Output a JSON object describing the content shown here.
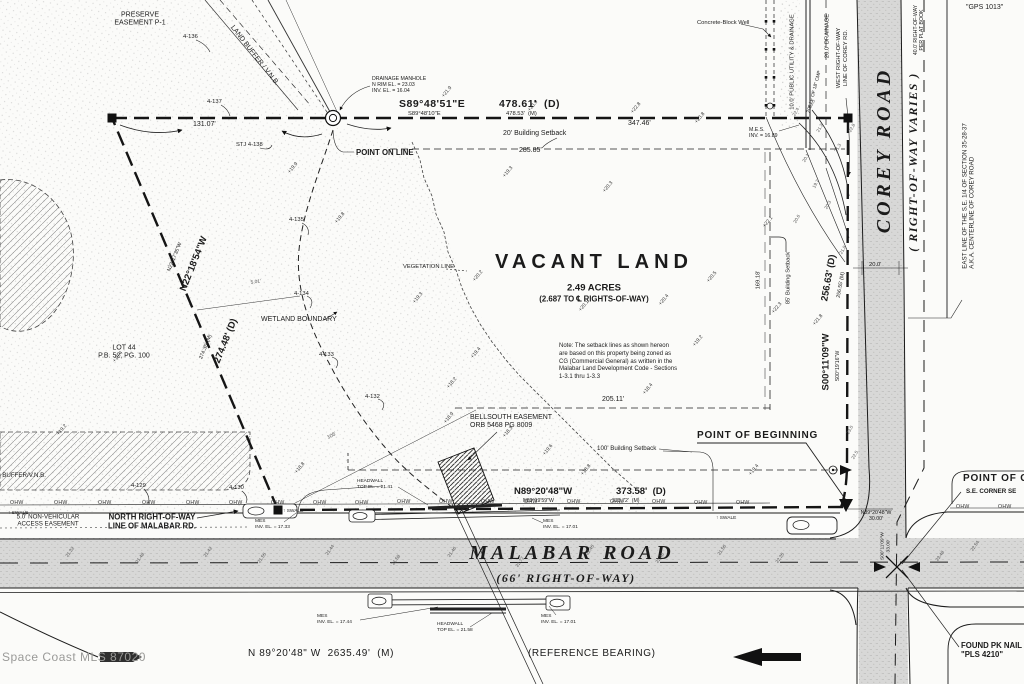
{
  "watermark": "Space Coast MLS 87020",
  "parcel": {
    "title": "VACANT LAND",
    "area": "2.49 ACRES",
    "area_note": "(2.687 TO ℄ RIGHTS-OF-WAY)",
    "zoning_note": "Note: The setback lines as shown hereon\nare based on this property being zoned as\nCG (Commercial General) as written in the\nMalabar Land Development Code - Sections\n1-3.1 thru 1-3.3"
  },
  "roads": {
    "malabar": {
      "name": "MALABAR ROAD",
      "row": "(66' RIGHT-OF-WAY)",
      "ref_bearing": "N 89°20'48\" W  2635.49'  (M)",
      "ref_label": "(REFERENCE BEARING)"
    },
    "corey": {
      "name": "COREY ROAD",
      "row": "( RIGHT-OF-WAY VARIES )"
    }
  },
  "ohw": {
    "text": "OHW",
    "positions": [
      [
        10,
        500
      ],
      [
        54,
        500
      ],
      [
        98,
        500
      ],
      [
        142,
        500
      ],
      [
        186,
        500
      ],
      [
        229,
        500
      ],
      [
        271,
        500
      ],
      [
        313,
        500
      ],
      [
        355,
        500
      ],
      [
        397,
        499
      ],
      [
        439,
        499
      ],
      [
        481,
        499
      ],
      [
        524,
        499
      ],
      [
        567,
        499
      ],
      [
        610,
        499
      ],
      [
        652,
        499
      ],
      [
        694,
        500
      ],
      [
        736,
        500
      ],
      [
        956,
        504
      ],
      [
        998,
        504
      ]
    ]
  },
  "labels": [
    {
      "id": "preserve-easement-label",
      "t": "PRESERVE\nEASEMENT P-1",
      "x": 140,
      "y": 20,
      "cls": "t7 ctr",
      "a": "c"
    },
    {
      "id": "land-buffer-diagonal-label",
      "t": "LAND BUFFER / V.N.B.",
      "x": 254,
      "y": 56,
      "cls": "t7",
      "rot": 52,
      "a": "c"
    },
    {
      "id": "flag-4-136",
      "t": "4-136",
      "x": 183,
      "y": 34,
      "cls": "t55"
    },
    {
      "id": "flag-4-137",
      "t": "4-137",
      "x": 207,
      "y": 99,
      "cls": "t55"
    },
    {
      "id": "dim-131-07",
      "t": "131.07'",
      "x": 193,
      "y": 121,
      "cls": "t7"
    },
    {
      "id": "flag-stj-4-138",
      "t": "STJ 4-138",
      "x": 236,
      "y": 142,
      "cls": "t55"
    },
    {
      "id": "drainage-manhole-callout",
      "t": "DRAINAGE MANHOLE\nN RIM EL. = 23.03\nINV. EL. = 16.04",
      "x": 372,
      "y": 76,
      "cls": "t5"
    },
    {
      "id": "north-bearing-d",
      "t": "S89°48'51\"E",
      "x": 399,
      "y": 98,
      "cls": "t11"
    },
    {
      "id": "north-dist-d",
      "t": "478.61'  (D)",
      "x": 499,
      "y": 98,
      "cls": "t11"
    },
    {
      "id": "north-bearing-m",
      "t": "S89°48'10\"E",
      "x": 408,
      "y": 111,
      "cls": "t55"
    },
    {
      "id": "north-dist-m",
      "t": "478.53'  (M)",
      "x": 506,
      "y": 111,
      "cls": "t55"
    },
    {
      "id": "dim-347-46",
      "t": "347.46'",
      "x": 628,
      "y": 120,
      "cls": "t7"
    },
    {
      "id": "setback-20-label",
      "t": "20' Building Setback",
      "x": 503,
      "y": 130,
      "cls": "t7"
    },
    {
      "id": "dim-285-85",
      "t": "285.85'",
      "x": 519,
      "y": 147,
      "cls": "t7"
    },
    {
      "id": "point-on-line-label",
      "t": "POINT ON LINE",
      "x": 356,
      "y": 148,
      "cls": "t8"
    },
    {
      "id": "concrete-well-label",
      "t": "Concrete-Block Well",
      "x": 697,
      "y": 20,
      "cls": "t55"
    },
    {
      "id": "utility-easement-label",
      "t": "10.0' PUBLIC UTILITY & DRAINAGE",
      "x": 793,
      "y": 62,
      "cls": "t55",
      "rot": -90,
      "a": "c"
    },
    {
      "id": "drainage-20-label",
      "t": "20.0' DRAINAGE",
      "x": 828,
      "y": 36,
      "cls": "t55",
      "rot": -90,
      "a": "c"
    },
    {
      "id": "cmp-label",
      "t": "206 LF OF 18\" CMP",
      "x": 815,
      "y": 92,
      "cls": "t45",
      "rot": -75,
      "a": "c"
    },
    {
      "id": "west-row-corey-label",
      "t": "WEST RIGHT-OF-WAY\nLINE OF COREY RD.",
      "x": 843,
      "y": 58,
      "cls": "t55 ctr",
      "rot": -90,
      "a": "c"
    },
    {
      "id": "mes-ne-label",
      "t": "M.E.S.\nINV. = 16.89",
      "x": 749,
      "y": 127,
      "cls": "t5"
    },
    {
      "id": "plat-row-label",
      "t": "40.0' RIGHT-OF-WAY\nPER PLAT BOOK",
      "x": 919,
      "y": 30,
      "cls": "t5 ctr",
      "rot": -90,
      "a": "c"
    },
    {
      "id": "gps-label",
      "t": "\"GPS 1013\"",
      "x": 966,
      "y": 4,
      "cls": "t7"
    },
    {
      "id": "east-line-corey-label",
      "t": "EAST LINE OF THE S.E. 1/4 OF SECTION 35-28-37\nA.K.A. CENTERLINE OF COREY ROAD",
      "x": 969,
      "y": 196,
      "cls": "t6",
      "rot": -90,
      "a": "c"
    },
    {
      "id": "dim-20-0",
      "t": "20.0'",
      "x": 869,
      "y": 262,
      "cls": "t55"
    },
    {
      "id": "east-dist-d",
      "t": "256.63' (D)",
      "x": 829,
      "y": 278,
      "cls": "t10",
      "rot": -80,
      "a": "c"
    },
    {
      "id": "east-dist-m",
      "t": "256.55' (M)",
      "x": 841,
      "y": 285,
      "cls": "t5",
      "rot": -80,
      "a": "c"
    },
    {
      "id": "east-bearing-d",
      "t": "S00°11'09\"W",
      "x": 826,
      "y": 362,
      "cls": "t10",
      "rot": -90,
      "a": "c"
    },
    {
      "id": "east-bearing-m",
      "t": "S00°19'16\"W",
      "x": 838,
      "y": 366,
      "cls": "t5",
      "rot": -90,
      "a": "c"
    },
    {
      "id": "setback-85-label",
      "t": "85' Building Setback",
      "x": 789,
      "y": 278,
      "cls": "t55",
      "rot": -90,
      "a": "c"
    },
    {
      "id": "dim-169-18",
      "t": "169.18'",
      "x": 759,
      "y": 280,
      "cls": "t55",
      "rot": -90,
      "a": "c"
    },
    {
      "id": "dim-205-11",
      "t": "205.11'",
      "x": 602,
      "y": 396,
      "cls": "t7"
    },
    {
      "id": "setback-100-label",
      "t": "100' Building Setback",
      "x": 597,
      "y": 445,
      "cls": "t6"
    },
    {
      "id": "pob-label",
      "t": "POINT OF BEGINNING",
      "x": 697,
      "y": 430,
      "cls": "t12"
    },
    {
      "id": "south-bearing-d",
      "t": "N89°20'48\"W",
      "x": 514,
      "y": 486,
      "cls": "t10"
    },
    {
      "id": "south-dist-d",
      "t": "373.58'  (D)",
      "x": 616,
      "y": 486,
      "cls": "t10"
    },
    {
      "id": "south-bearing-m",
      "t": "N89°19'59\"W",
      "x": 523,
      "y": 498,
      "cls": "t5"
    },
    {
      "id": "south-dist-m",
      "t": "373.72'  (M)",
      "x": 612,
      "y": 498,
      "cls": "t5"
    },
    {
      "id": "bellsouth-label",
      "t": "BELLSOUTH EASEMENT\nORB 5468 PG 8009",
      "x": 470,
      "y": 414,
      "cls": "t7"
    },
    {
      "id": "wetland-boundary-label",
      "t": "WETLAND BOUNDARY",
      "x": 261,
      "y": 316,
      "cls": "t7"
    },
    {
      "id": "vegetation-line-label",
      "t": "VEGETATION LINE",
      "x": 403,
      "y": 264,
      "cls": "t55"
    },
    {
      "id": "west-bearing-d",
      "t": "N22°18'54\"W",
      "x": 194,
      "y": 264,
      "cls": "t10",
      "rot": -68,
      "a": "c"
    },
    {
      "id": "west-bearing-m",
      "t": "N22°17'35\"W",
      "x": 175,
      "y": 257,
      "cls": "t5",
      "rot": -68,
      "a": "c"
    },
    {
      "id": "west-dist-d",
      "t": "274.48' (D)",
      "x": 226,
      "y": 341,
      "cls": "t10",
      "rot": -68,
      "a": "c"
    },
    {
      "id": "west-dist-m",
      "t": "274.35' (M)",
      "x": 206,
      "y": 347,
      "cls": "t5",
      "rot": -68,
      "a": "c"
    },
    {
      "id": "lot-44-label",
      "t": "LOT 44\nP.B. 52, PG. 100",
      "x": 124,
      "y": 353,
      "cls": "t7 ctr",
      "a": "c"
    },
    {
      "id": "dim-105",
      "t": "105'",
      "x": 332,
      "y": 436,
      "cls": "t5 gry",
      "rot": -28,
      "a": "c"
    },
    {
      "id": "dim-5-01",
      "t": "5.01'",
      "x": 256,
      "y": 283,
      "cls": "t45 gry",
      "rot": -8,
      "a": "c"
    },
    {
      "id": "flag-4-135",
      "t": "4-135",
      "x": 289,
      "y": 217,
      "cls": "t55"
    },
    {
      "id": "flag-4-134",
      "t": "4-134",
      "x": 294,
      "y": 291,
      "cls": "t55"
    },
    {
      "id": "flag-4-133",
      "t": "4-133",
      "x": 319,
      "y": 352,
      "cls": "t55"
    },
    {
      "id": "flag-4-132",
      "t": "4-132",
      "x": 365,
      "y": 394,
      "cls": "t55"
    },
    {
      "id": "flag-4-129",
      "t": "4-129",
      "x": 131,
      "y": 483,
      "cls": "t55"
    },
    {
      "id": "flag-4-130",
      "t": "4-130",
      "x": 229,
      "y": 485,
      "cls": "t55"
    },
    {
      "id": "land-buffer-left-label",
      "t": "LAND BUFFER/V.N.B.",
      "x": -16,
      "y": 472,
      "cls": "t6"
    },
    {
      "id": "nonvehicular-easement-label",
      "t": "5.0' NON-VEHICULAR\nACCESS EASEMENT",
      "x": 48,
      "y": 521,
      "cls": "t6 ctr",
      "a": "c"
    },
    {
      "id": "north-row-malabar-label",
      "t": "NORTH RIGHT-OF-WAY\nLINE OF MALABAR RD.",
      "x": 152,
      "y": 522,
      "cls": "t8 ctr",
      "a": "c"
    },
    {
      "id": "swale-label-1",
      "t": "↑ SWALE",
      "x": 8,
      "y": 511,
      "cls": "t45"
    },
    {
      "id": "swale-label-2",
      "t": "↑ SWALE",
      "x": 283,
      "y": 509,
      "cls": "t45"
    },
    {
      "id": "swale-label-3",
      "t": "↑ SWALE",
      "x": 716,
      "y": 516,
      "cls": "t45"
    },
    {
      "id": "mes-west-label",
      "t": "MES\nINV. EL. = 17.33",
      "x": 255,
      "y": 519,
      "cls": "t45"
    },
    {
      "id": "mes-mid-label",
      "t": "MES\nINV. EL. = 17.01",
      "x": 543,
      "y": 519,
      "cls": "t45"
    },
    {
      "id": "headwall-north-label",
      "t": "HEADWALL\nTOP EL. = 21.41",
      "x": 357,
      "y": 479,
      "cls": "t45"
    },
    {
      "id": "tie-30-label",
      "t": "N89°20'48\"W\n30.00'",
      "x": 876,
      "y": 516,
      "cls": "t5 ctr",
      "a": "c"
    },
    {
      "id": "corey-ext-label",
      "t": "S00°11'09\"W\n33.00'",
      "x": 886,
      "y": 546,
      "cls": "t45 ctr",
      "rot": -90,
      "a": "c"
    },
    {
      "id": "poc-label",
      "t": "POINT OF C",
      "x": 963,
      "y": 473,
      "cls": "t12"
    },
    {
      "id": "poc-sub-label",
      "t": "S.E. CORNER SE",
      "x": 966,
      "y": 488,
      "cls": "t6b"
    },
    {
      "id": "pk-nail-label",
      "t": "FOUND PK NAIL\n\"PLS 4210\"",
      "x": 961,
      "y": 641,
      "cls": "t8"
    },
    {
      "id": "mes-sw-label",
      "t": "MES\nINV. EL. = 17.44",
      "x": 317,
      "y": 614,
      "cls": "t45"
    },
    {
      "id": "headwall-south-label",
      "t": "HEADWALL\nTOP EL. = 21.58",
      "x": 437,
      "y": 622,
      "cls": "t45"
    },
    {
      "id": "mes-se-label",
      "t": "MES\nINV. EL. = 17.01",
      "x": 541,
      "y": 614,
      "cls": "t45"
    }
  ],
  "spot_elevations": [
    {
      "t": "+21.9",
      "x": 447,
      "y": 92
    },
    {
      "t": "+23.9",
      "x": 533,
      "y": 106
    },
    {
      "t": "+22.8",
      "x": 636,
      "y": 108
    },
    {
      "t": "+19.9",
      "x": 293,
      "y": 168
    },
    {
      "t": "+19.8",
      "x": 340,
      "y": 218
    },
    {
      "t": "+19.3",
      "x": 508,
      "y": 172
    },
    {
      "t": "+20.2",
      "x": 478,
      "y": 276
    },
    {
      "t": "+20.1",
      "x": 584,
      "y": 306
    },
    {
      "t": "+20.4",
      "x": 664,
      "y": 300
    },
    {
      "t": "+20.5",
      "x": 712,
      "y": 277
    },
    {
      "t": "+19.3",
      "x": 418,
      "y": 298
    },
    {
      "t": "+19.4",
      "x": 476,
      "y": 353
    },
    {
      "t": "+18.2",
      "x": 452,
      "y": 383
    },
    {
      "t": "+18.9",
      "x": 449,
      "y": 418
    },
    {
      "t": "+18.3",
      "x": 508,
      "y": 432
    },
    {
      "t": "+19.6",
      "x": 548,
      "y": 450
    },
    {
      "t": "+19.2",
      "x": 698,
      "y": 341
    },
    {
      "t": "+18.4",
      "x": 648,
      "y": 389
    },
    {
      "t": "+19.4",
      "x": 118,
      "y": 357
    },
    {
      "t": "+19.2",
      "x": 62,
      "y": 430
    },
    {
      "t": "+20.3",
      "x": 608,
      "y": 187
    },
    {
      "t": "+23.8",
      "x": 700,
      "y": 118
    },
    {
      "t": "+22.1",
      "x": 768,
      "y": 222
    },
    {
      "t": "+22.3",
      "x": 777,
      "y": 308
    },
    {
      "t": "+21.8",
      "x": 818,
      "y": 320
    },
    {
      "t": "+19.4",
      "x": 754,
      "y": 470
    },
    {
      "t": "+18.8",
      "x": 586,
      "y": 470
    },
    {
      "t": "+18.8",
      "x": 300,
      "y": 468
    }
  ],
  "small_numbers": [
    {
      "t": "21.32",
      "x": 70,
      "y": 552,
      "rot": -55
    },
    {
      "t": "21.48",
      "x": 140,
      "y": 558,
      "rot": -55
    },
    {
      "t": "21.42",
      "x": 208,
      "y": 552,
      "rot": -55
    },
    {
      "t": "21.55",
      "x": 262,
      "y": 558,
      "rot": -55
    },
    {
      "t": "21.44",
      "x": 330,
      "y": 550,
      "rot": -55
    },
    {
      "t": "21.58",
      "x": 396,
      "y": 560,
      "rot": -55
    },
    {
      "t": "21.46",
      "x": 452,
      "y": 552,
      "rot": -55
    },
    {
      "t": "22.77",
      "x": 520,
      "y": 562,
      "rot": -55
    },
    {
      "t": "23.45",
      "x": 590,
      "y": 550,
      "rot": -55
    },
    {
      "t": "22.46",
      "x": 660,
      "y": 558,
      "rot": -55
    },
    {
      "t": "21.56",
      "x": 722,
      "y": 550,
      "rot": -55
    },
    {
      "t": "22.35",
      "x": 780,
      "y": 558,
      "rot": -55
    },
    {
      "t": "23.48",
      "x": 940,
      "y": 556,
      "rot": -55
    },
    {
      "t": "22.54",
      "x": 975,
      "y": 546,
      "rot": -55
    },
    {
      "t": "22.4",
      "x": 796,
      "y": 112,
      "rot": -60
    },
    {
      "t": "23.0",
      "x": 812,
      "y": 104,
      "rot": -60
    },
    {
      "t": "21.2",
      "x": 820,
      "y": 128,
      "rot": -60
    },
    {
      "t": "20.1",
      "x": 806,
      "y": 158,
      "rot": -60
    },
    {
      "t": "19.7",
      "x": 816,
      "y": 184,
      "rot": -60
    },
    {
      "t": "20.3",
      "x": 828,
      "y": 205,
      "rot": -60
    },
    {
      "t": "21.3",
      "x": 838,
      "y": 148,
      "rot": -60
    },
    {
      "t": "20.6",
      "x": 797,
      "y": 219,
      "rot": -60
    },
    {
      "t": "21.8",
      "x": 843,
      "y": 250,
      "rot": -60
    },
    {
      "t": "22.8",
      "x": 852,
      "y": 128,
      "rot": -60
    },
    {
      "t": "23.0",
      "x": 850,
      "y": 430,
      "rot": -60
    },
    {
      "t": "22.5",
      "x": 855,
      "y": 455,
      "rot": -60
    }
  ]
}
